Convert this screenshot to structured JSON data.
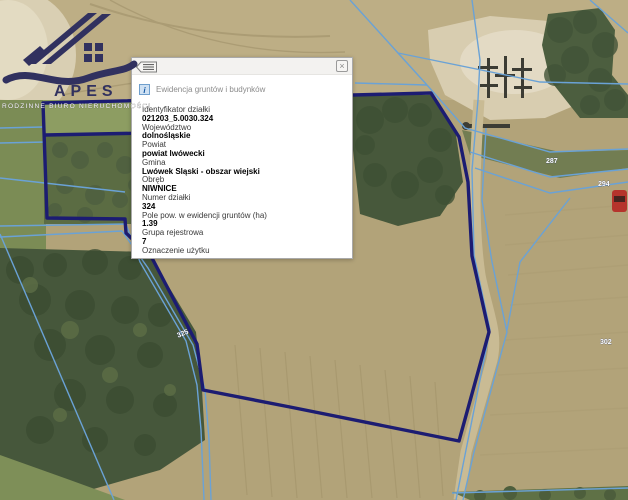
{
  "logo": {
    "brand": "APES",
    "tagline": "RODZINNE BIURO NIERUCHOMOŚCI"
  },
  "popup": {
    "header": {
      "close_glyph": "×"
    },
    "info_icon_glyph": "i",
    "title": "Ewidencja gruntów i budynków",
    "fields": [
      {
        "label": "Identyfikator działki",
        "value": "021203_5.0030.324"
      },
      {
        "label": "Województwo",
        "value": "dolnośląskie"
      },
      {
        "label": "Powiat",
        "value": "powiat lwówecki"
      },
      {
        "label": "Gmina",
        "value": "Lwówek Śląski - obszar wiejski"
      },
      {
        "label": "Obręb",
        "value": "NIWNICE"
      },
      {
        "label": "Numer działki",
        "value": "324"
      },
      {
        "label": "Pole pow. w ewidencji gruntów (ha)",
        "value": "1.39"
      },
      {
        "label": "Grupa rejestrowa",
        "value": "7"
      },
      {
        "label": "Oznaczenie użytku",
        "value": ""
      }
    ]
  },
  "map": {
    "colors": {
      "parcel_boundary": "#1c1c72",
      "cadastral_line": "#6aa2d6"
    },
    "parcel_labels": [
      {
        "text": "287"
      },
      {
        "text": "294"
      },
      {
        "text": "302"
      },
      {
        "text": "325"
      }
    ]
  }
}
